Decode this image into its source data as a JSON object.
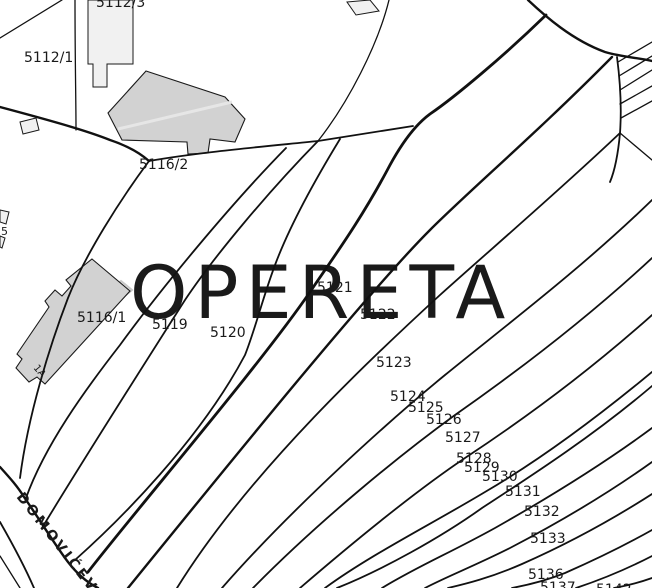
{
  "map": {
    "watermark": "OPERETA",
    "street": {
      "text": "DOMOVIĆEV",
      "x": 16,
      "y": 497,
      "rotation": 52,
      "size": 14
    },
    "colors": {
      "background": "#ffffff",
      "boundary_line": "#111111",
      "building_fill_dark": "#d2d2d2",
      "building_fill_light": "#f1f1f1",
      "watermark": "#c9c9c9",
      "label": "#1a1a1a"
    },
    "parcel_labels": [
      {
        "text": "5112/3",
        "x": 96,
        "y": 7,
        "size": 14
      },
      {
        "text": "5112/1",
        "x": 24,
        "y": 62,
        "size": 14
      },
      {
        "text": "5116/2",
        "x": 139,
        "y": 169,
        "size": 14
      },
      {
        "text": "5116/1",
        "x": 77,
        "y": 322,
        "size": 14
      },
      {
        "text": "5",
        "x": 1,
        "y": 235,
        "size": 11
      },
      {
        "text": "1A",
        "x": 33,
        "y": 368,
        "size": 10,
        "rotation": 50
      },
      {
        "text": "5119",
        "x": 152,
        "y": 329,
        "size": 14
      },
      {
        "text": "5120",
        "x": 210,
        "y": 337,
        "size": 14
      },
      {
        "text": "5121",
        "x": 317,
        "y": 292,
        "size": 14
      },
      {
        "text": "5122",
        "x": 360,
        "y": 319,
        "size": 14
      },
      {
        "text": "5123",
        "x": 376,
        "y": 367,
        "size": 14
      },
      {
        "text": "5124",
        "x": 390,
        "y": 401,
        "size": 14
      },
      {
        "text": "5125",
        "x": 408,
        "y": 412,
        "size": 14
      },
      {
        "text": "5126",
        "x": 426,
        "y": 424,
        "size": 14
      },
      {
        "text": "5127",
        "x": 445,
        "y": 442,
        "size": 14
      },
      {
        "text": "5128",
        "x": 456,
        "y": 463,
        "size": 14
      },
      {
        "text": "5129",
        "x": 464,
        "y": 472,
        "size": 14
      },
      {
        "text": "5130",
        "x": 482,
        "y": 481,
        "size": 14
      },
      {
        "text": "5131",
        "x": 505,
        "y": 496,
        "size": 14
      },
      {
        "text": "5132",
        "x": 524,
        "y": 516,
        "size": 14
      },
      {
        "text": "5133",
        "x": 530,
        "y": 543,
        "size": 14
      },
      {
        "text": "5136",
        "x": 528,
        "y": 579,
        "size": 14
      },
      {
        "text": "5137",
        "x": 540,
        "y": 592,
        "size": 14
      },
      {
        "text": "5142",
        "x": 596,
        "y": 594,
        "size": 14
      }
    ]
  }
}
